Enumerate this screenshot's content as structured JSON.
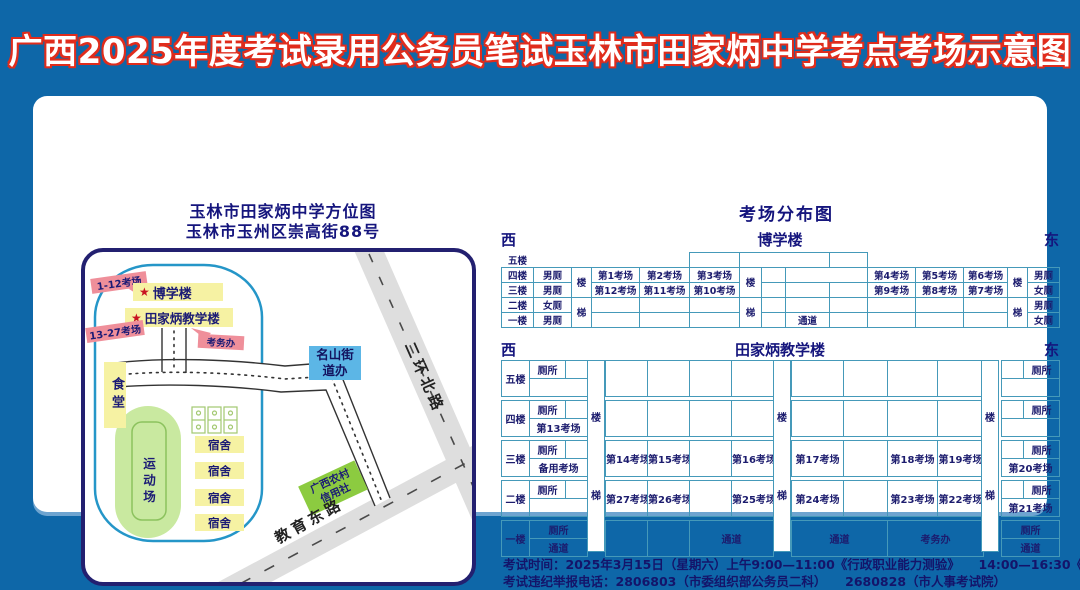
{
  "page_title": "广西2025年度考试录用公务员笔试玉林市田家炳中学考点考场示意图",
  "icons": {
    "star": "★"
  },
  "map_panel": {
    "title_line1": "玉林市田家炳中学方位图",
    "title_line2": "玉林市玉州区崇高街88号",
    "tag_rooms_1_12": "1-12考场",
    "tag_rooms_13_27": "13-27考场",
    "building_boxue": "博学楼",
    "building_tianjiabing": "田家炳教学楼",
    "tag_kaowuban": "考务办",
    "mingshan_line1": "名山街",
    "mingshan_line2": "道办",
    "canteen": "食堂",
    "sports_ground": "运动场",
    "dorm": "宿舍",
    "credit_union_line1": "广西农村",
    "credit_union_line2": "信用社",
    "road_north": "二环北路",
    "road_east": "教育东路"
  },
  "dist_panel": {
    "title": "考场分布图",
    "west": "西",
    "east": "东",
    "boxue": {
      "name": "博学楼",
      "floors": [
        "五楼",
        "四楼",
        "三楼",
        "二楼",
        "一楼"
      ],
      "stair_upper": "楼",
      "stair_lower": "梯",
      "aisle": "通道",
      "f4": {
        "wc_left": "男厕",
        "rooms": [
          "第1考场",
          "第2考场",
          "第3考场",
          "第4考场",
          "第5考场",
          "第6考场"
        ],
        "wc_right": "男厕"
      },
      "f3": {
        "wc_left": "男厕",
        "rooms": [
          "第12考场",
          "第11考场",
          "第10考场",
          "第9考场",
          "第8考场",
          "第7考场"
        ],
        "wc_right": "女厕"
      },
      "f2": {
        "wc_left": "女厕",
        "wc_right": "男厕"
      },
      "f1": {
        "wc_left": "男厕",
        "wc_right": "女厕"
      }
    },
    "tianjiabing": {
      "name": "田家炳教学楼",
      "floors": [
        "五楼",
        "四楼",
        "三楼",
        "二楼",
        "一楼"
      ],
      "stair_upper": "楼",
      "stair_lower": "梯",
      "wc": "厕所",
      "aisle": "通道",
      "f4": {
        "room_left": "第13考场"
      },
      "f3": {
        "room_left_sub": "备用考场",
        "rooms_left": [
          "第14考场",
          "第15考场",
          "第16考场"
        ],
        "rooms_right": [
          "第17考场",
          "第18考场",
          "第19考场"
        ],
        "room_right_sub": "第20考场"
      },
      "f2": {
        "rooms_left": [
          "第27考场",
          "第26考场",
          "第25考场"
        ],
        "rooms_right": [
          "第24考场",
          "第23考场",
          "第22考场"
        ],
        "room_right_sub": "第21考场"
      },
      "f1": {
        "office": "考务办"
      }
    }
  },
  "footer": {
    "line1": "考试时间：2025年3月15日（星期六）上午9:00—11:00《行政职业能力测验》　　14:00—16:30《申论》",
    "line2": "考试违纪举报电话：2806803（市委组织部公务员二科）　　2680828（市人事考试院）"
  }
}
